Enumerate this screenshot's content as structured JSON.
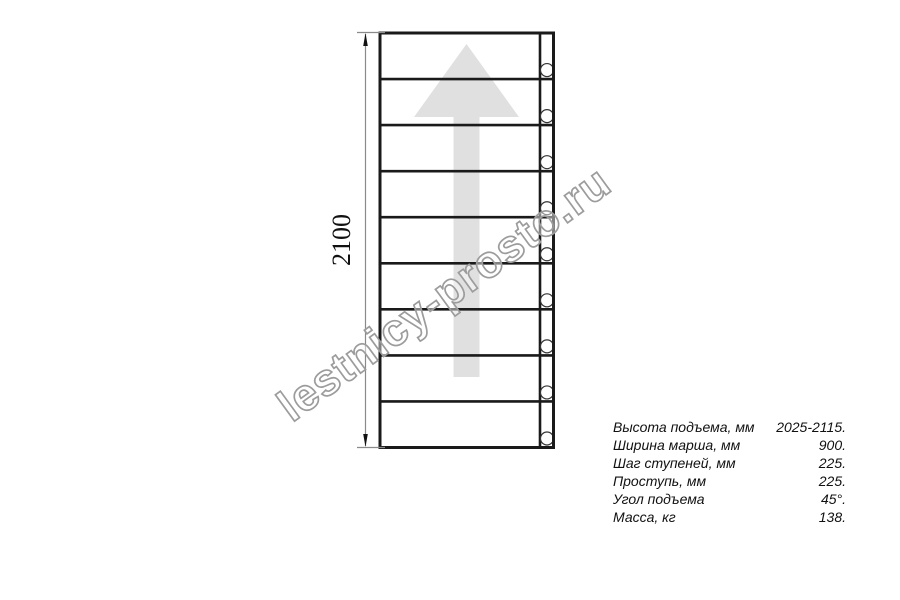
{
  "drawing": {
    "height_dimension": "2100",
    "steps_count": 9,
    "colors": {
      "line": "#1a1a1a",
      "arrow_fill": "#e0e0e0",
      "dimension_line": "#8a8a8a",
      "hole_stroke": "#333333",
      "watermark_stroke": "#9c9c9c"
    }
  },
  "watermark": {
    "text": "lestnicy-prosto.ru"
  },
  "specs": {
    "rows": [
      {
        "label": "Высота подъема, мм",
        "value": "2025-2115."
      },
      {
        "label": "Ширина марша, мм",
        "value": "900."
      },
      {
        "label": "Шаг ступеней, мм",
        "value": "225."
      },
      {
        "label": "Проступь, мм",
        "value": "225."
      },
      {
        "label": "Угол подъема",
        "value": "45°."
      },
      {
        "label": "Масса, кг",
        "value": "138."
      }
    ]
  }
}
